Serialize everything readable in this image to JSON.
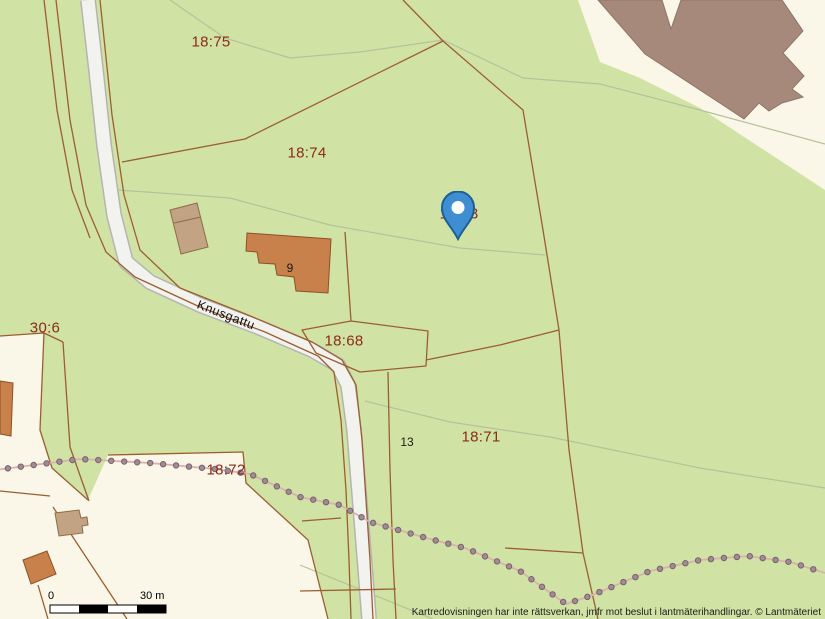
{
  "map": {
    "parcels": [
      {
        "label": "18:75"
      },
      {
        "label": "18:74"
      },
      {
        "label": "18:73"
      },
      {
        "label": "18:68"
      },
      {
        "label": "18:71"
      },
      {
        "label": "18:72"
      },
      {
        "label": "30:6"
      }
    ],
    "house_numbers": [
      {
        "label": "9"
      },
      {
        "label": "13"
      }
    ],
    "road": {
      "name": "Knusgattu"
    },
    "icons": {
      "marker": "map-pin"
    },
    "scale_bar": {
      "start_label": "0",
      "end_label": "30 m"
    },
    "attribution": "Kartredovisningen har inte rättsverkan, jmfr mot beslut i lantmäterihandlingar. © Lantmäteriet",
    "colors": {
      "land_green": "#d0e3a5",
      "land_cream": "#faf6e8",
      "parcel_label_red": "#8b2b1a",
      "boundary_brown": "#9c5e30",
      "road_fill": "#f2f2ef",
      "building_taupe": "#a6897b",
      "building_orange": "#c8814b",
      "building_tan": "#c2a484",
      "footpath_dot": "#9a858e",
      "marker_blue": "#3e8ed1"
    }
  }
}
